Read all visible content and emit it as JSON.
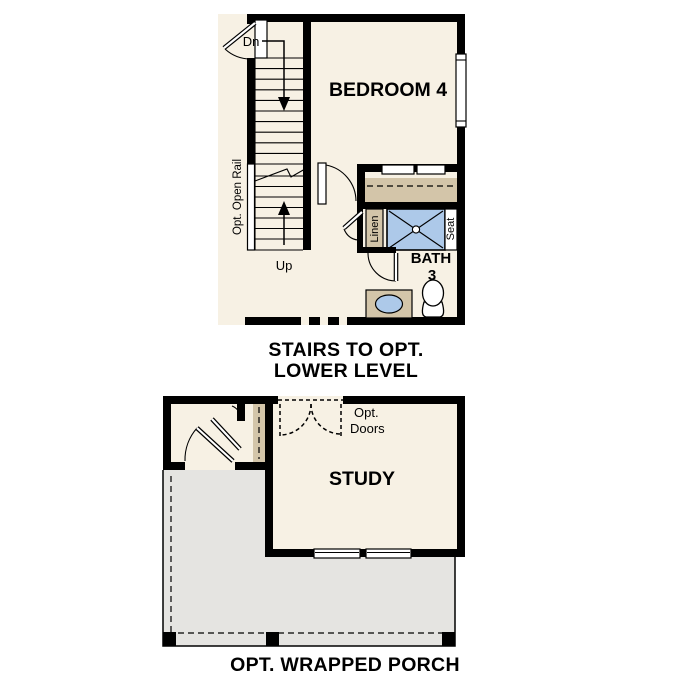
{
  "colors": {
    "wall": "#000000",
    "floor": "#f7f1e4",
    "porch": "#e5e4e1",
    "cabinet_tan": "#d3c5a9",
    "fixture_blue": "#adc9e9",
    "window_white": "#ffffff"
  },
  "upper_plan": {
    "room_label": "BEDROOM 4",
    "stairs_down_label": "Dn",
    "stairs_up_label": "Up",
    "open_rail_label": "Opt. Open Rail",
    "linen_label": "Linen",
    "seat_label": "Seat",
    "bath_label": "BATH",
    "bath_number": "3",
    "caption_line1": "STAIRS TO OPT.",
    "caption_line2": "LOWER LEVEL"
  },
  "lower_plan": {
    "room_label": "STUDY",
    "optional_doors_line1": "Opt.",
    "optional_doors_line2": "Doors",
    "caption": "OPT. WRAPPED PORCH"
  }
}
